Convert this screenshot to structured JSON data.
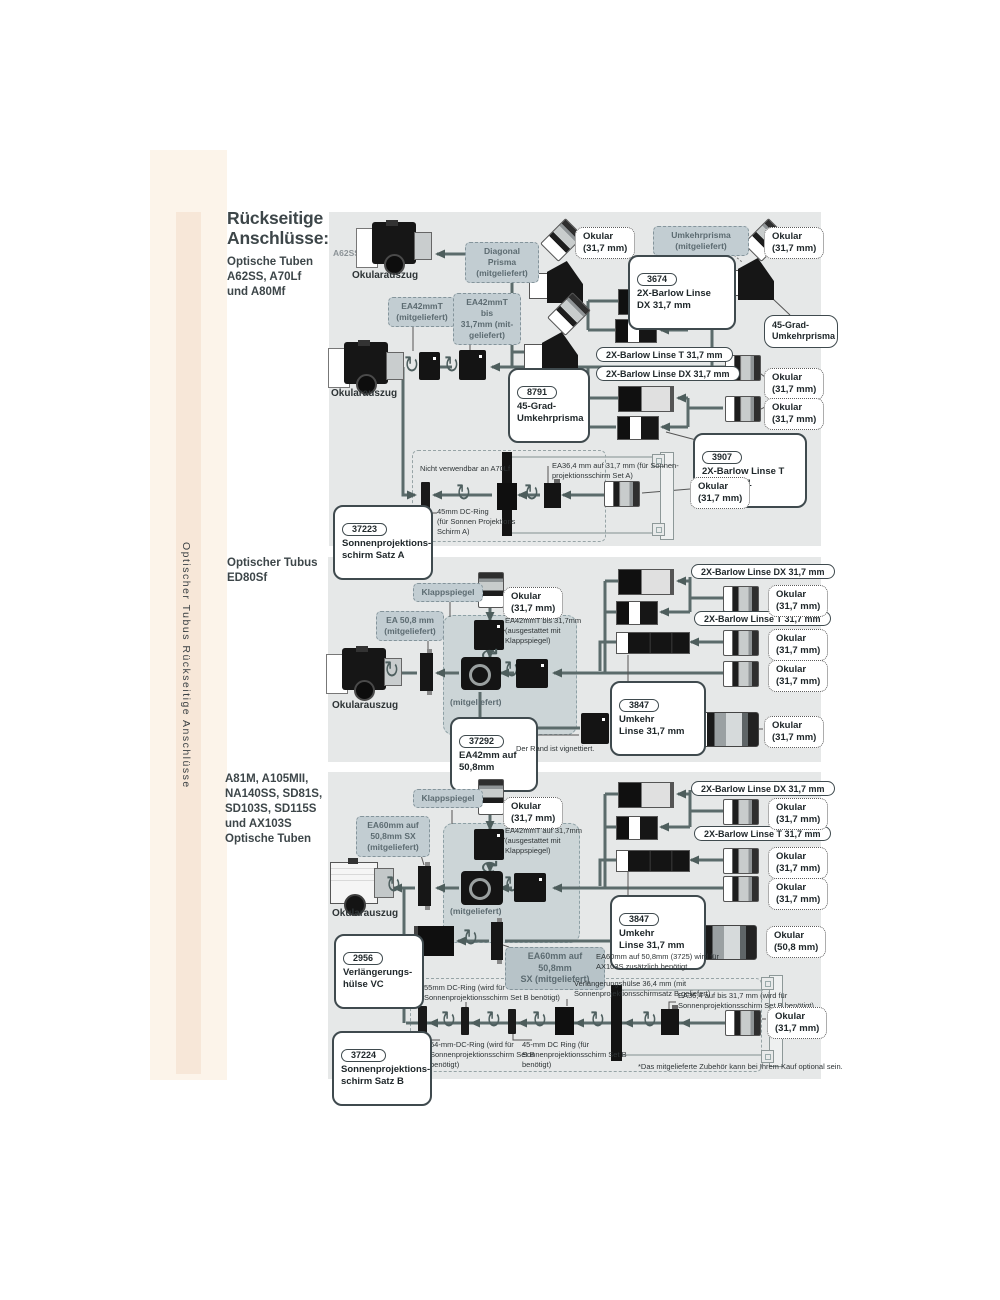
{
  "palette": {
    "panel_bg": "#e6e8e8",
    "inner_panel_bg": "#ccd5d7",
    "graybox_bg": "#c2cdd2",
    "line_color": "#5b6b6b",
    "sidebar_band": "#fcf4ea",
    "sidebar_strip": "#f7e7d8"
  },
  "icons": {
    "rotate_glyph": "↻"
  },
  "sidebar": {
    "vertical_text": "Optischer Tubus Rückseitige Anschlüsse"
  },
  "header": {
    "title": "Rückseitige\nAnschlüsse:",
    "subtitle": "Optische Tuben\nA62SS, A70Lf\nund A80Mf"
  },
  "common": {
    "okular_317": "Okular\n(31,7 mm)",
    "okular_508": "Okular\n(50,8 mm)",
    "okularauszug": "Okularauszug",
    "mitgeliefert": "(mitgeliefert)",
    "klappspiegel": "Klappspiegel",
    "pill_barlow_dx": "2X-Barlow Linse DX 31,7 mm",
    "pill_barlow_t": "2X-Barlow Linse T 31,7 mm",
    "p3847_num": "3847",
    "p3847_text": "Umkehr\nLinse 31,7 mm"
  },
  "top": {
    "scope_model": "A62SS",
    "diagonal_prisma": "Diagonal Prisma\n(mitgeliefert)",
    "umkehrprisma": "Umkehrprisma\n(mitgeliefert)",
    "p3674_num": "3674",
    "p3674_text": "2X-Barlow Linse\nDX 31,7 mm",
    "ea42mmt": "EA42mmT\n(mitgeliefert)",
    "ea42mmt_bis": "EA42mmT bis\n31,7mm (mit-\ngeliefert)",
    "umkehrprisma_45": "45-Grad-\nUmkehrprisma",
    "p8791_num": "8791",
    "p8791_text": "45-Grad-\nUmkehrprisma",
    "p3907_num": "3907",
    "p3907_text": "2X-Barlow Linse T\n31,7 mm *1",
    "nicht_verwendbar": "Nicht verwendbar an A70Lf",
    "ea364_note": "EA36,4 mm auf 31,7 mm (für Sonnen-\nprojektionsschirm Set A)",
    "dc45_note": "45mm DC-Ring\n(für Sonnen Projektions\nSchirm A)",
    "p37223_num": "37223",
    "p37223_text": "Sonnenprojektions-\nschirm Satz A"
  },
  "mid": {
    "title": "Optischer Tubus\nED80Sf",
    "ea508": "EA 50,8 mm\n(mitgeliefert)",
    "ea42_note": "EA42mmT bis 31,7mm\n(ausgestattet mit\nKlappspiegel)",
    "p37292_num": "37292",
    "p37292_text": "EA42mm auf\n50,8mm",
    "vignette_note": "Der Rand ist vignettiert."
  },
  "bot": {
    "title": "A81M, A105MII,\nNA140SS, SD81S,\nSD103S, SD115S\nund AX103S\nOptische Tuben",
    "ea60_sx": "EA60mm auf\n50,8mm SX\n(mitgeliefert)",
    "ea42_note": "EA42mmT auf 31,7mm\n(ausgestattet mit\nKlappspiegel)",
    "p2956_num": "2956",
    "p2956_text": "Verlängerungs-\nhülse VC",
    "ea60_sx2": "EA60mm auf 50,8mm\nSX (mitgeliefert)",
    "ea60_note": "EA60mm auf 50,8mm (3725) wird für\nAX103S zusätzlich benötigt",
    "dc55_note": "55mm DC-Ring (wird für\nSonnenprojektionsschirm Set B benötigt)",
    "huelse_note": "Verlängerungshülse 36,4 mm (mit\nSonnenprojektionsschirmsatz B geliefert)",
    "ea364_note": "EA36,4 auf bis 31,7 mm (wird für\nSonnenprojektionsschirm Set B benötigt)",
    "dc64_note": "64-mm-DC-Ring (wird für\nSonnenprojektionsschirm Set B\nbenötigt)",
    "dc45_note": "45-mm DC Ring (für\nSonnenprojektionsschirm Set B\nbenötigt)",
    "p37224_num": "37224",
    "p37224_text": "Sonnenprojektions-\nschirm Satz B",
    "footnote": "*Das mitgelieferte Zubehör kann bei Ihrem Kauf optional sein."
  }
}
